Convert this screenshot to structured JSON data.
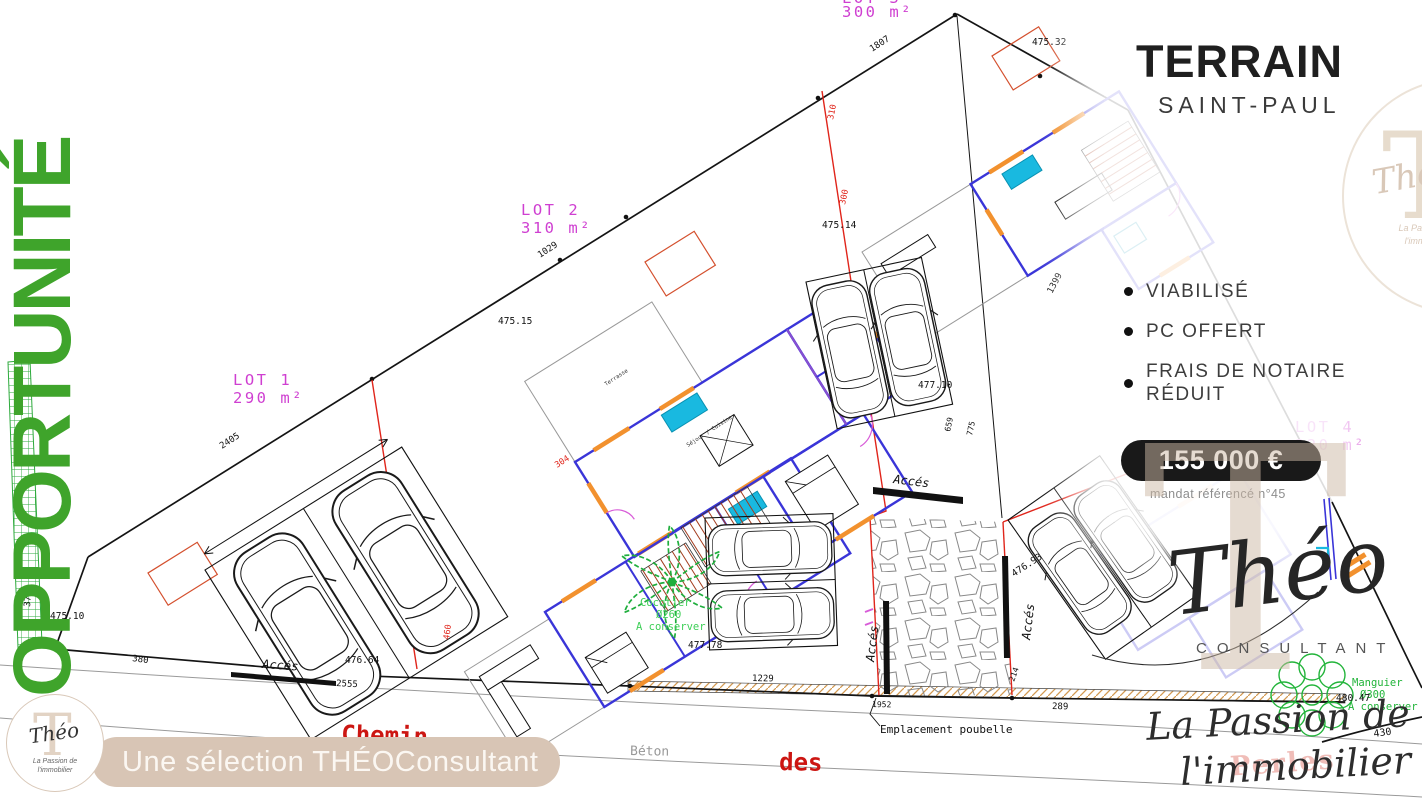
{
  "side_banner": {
    "text": "OPPORTUNITÉ"
  },
  "panel": {
    "title": "TERRAIN",
    "subtitle": "SAINT-PAUL",
    "features": [
      {
        "label": "VIABILISÉ"
      },
      {
        "label": "PC OFFERT"
      },
      {
        "label": "FRAIS DE NOTAIRE\nRÉDUIT"
      }
    ],
    "price": "155 000 €",
    "mandate": "mandat référencé n°45"
  },
  "brand": {
    "monogram": "T",
    "script_name": "Théo",
    "subtitle": "CONSULTANT",
    "tagline1": "La Passion de",
    "tagline2": "l'immobilier"
  },
  "footer": {
    "banner": "Une sélection THÉOConsultant",
    "logo": {
      "monogram": "T",
      "script_name": "Théo",
      "tagline1": "La Passion de",
      "tagline2": "l'immobilier"
    }
  },
  "plan": {
    "lots": [
      {
        "name": "LOT 1",
        "area": "290 m²"
      },
      {
        "name": "LOT 2",
        "area": "310 m²"
      },
      {
        "name": "LOT 3",
        "area": "300 m²"
      },
      {
        "name": "LOT 4",
        "area": "320 m²"
      }
    ],
    "roads": {
      "chemin": "Chemin",
      "des": "des",
      "perles": "Perles",
      "beton": "Béton"
    },
    "access_label": "Accés",
    "poubelle": "Emplacement poubelle",
    "trees": [
      {
        "name": "Cocotier",
        "diameter": "Ø260",
        "note": "A conserver"
      },
      {
        "name": "Manguier",
        "diameter": "Ø300",
        "note": "A conserver"
      }
    ],
    "room_labels": {
      "terrace": "Terrasse",
      "living": "Séjour / Cuisine"
    },
    "elevations": {
      "e1": "475.32",
      "e2": "475.14",
      "e3": "475.15",
      "e4": "477.10",
      "e5": "477.78",
      "e6": "476.64",
      "e7": "476.93",
      "e8": "480.47",
      "e9": "475.10"
    },
    "dims": {
      "d1807": "1807",
      "d1029": "1029",
      "d2405": "2405",
      "d2555": "2555",
      "d1229": "1229",
      "d380": "380",
      "d377": "377",
      "d289": "289",
      "d1952": "1952",
      "d430": "430",
      "d214": "214",
      "d1399": "1399",
      "d659": "659",
      "d775": "775",
      "d310": "310",
      "d304": "304",
      "d460": "460",
      "d300": "300"
    }
  },
  "colors": {
    "accent_green": "#3fa42b",
    "beige": "#d8c5b5",
    "lot_magenta": "#cf3fd1",
    "boundary_red": "#e0251b",
    "wall_blue": "#3a35d8",
    "price_bg": "#191919"
  }
}
